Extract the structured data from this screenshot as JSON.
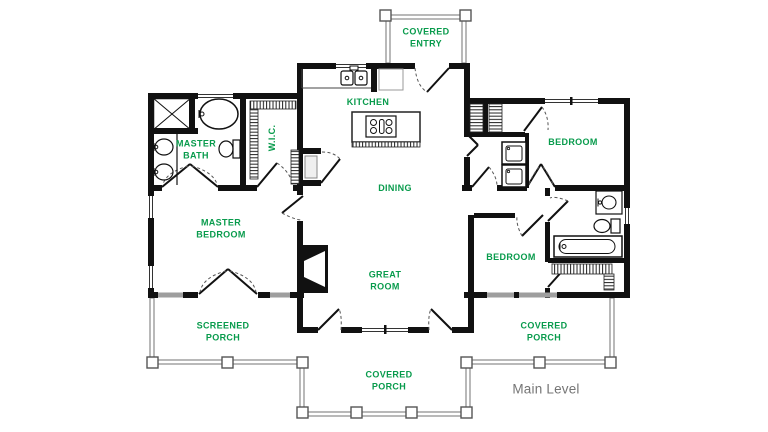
{
  "plan": {
    "level_label": "Main Level",
    "rooms": {
      "covered_entry": "COVERED\nENTRY",
      "kitchen": "KITCHEN",
      "master_bath": "MASTER\nBATH",
      "wic": "W.I.C.",
      "bedroom_ne": "BEDROOM",
      "dining": "DINING",
      "master_bedroom": "MASTER\nBEDROOM",
      "great_room": "GREAT\nROOM",
      "bedroom_se": "BEDROOM",
      "screened_porch": "SCREENED\nPORCH",
      "covered_porch_side": "COVERED\nPORCH",
      "covered_porch_front": "COVERED\nPORCH"
    },
    "colors": {
      "room_label": "#089b4c",
      "level_label": "#757575",
      "walls": "#111111",
      "window_glass": "#9e9e9e",
      "porch_rail": "#8a8a8a"
    }
  }
}
